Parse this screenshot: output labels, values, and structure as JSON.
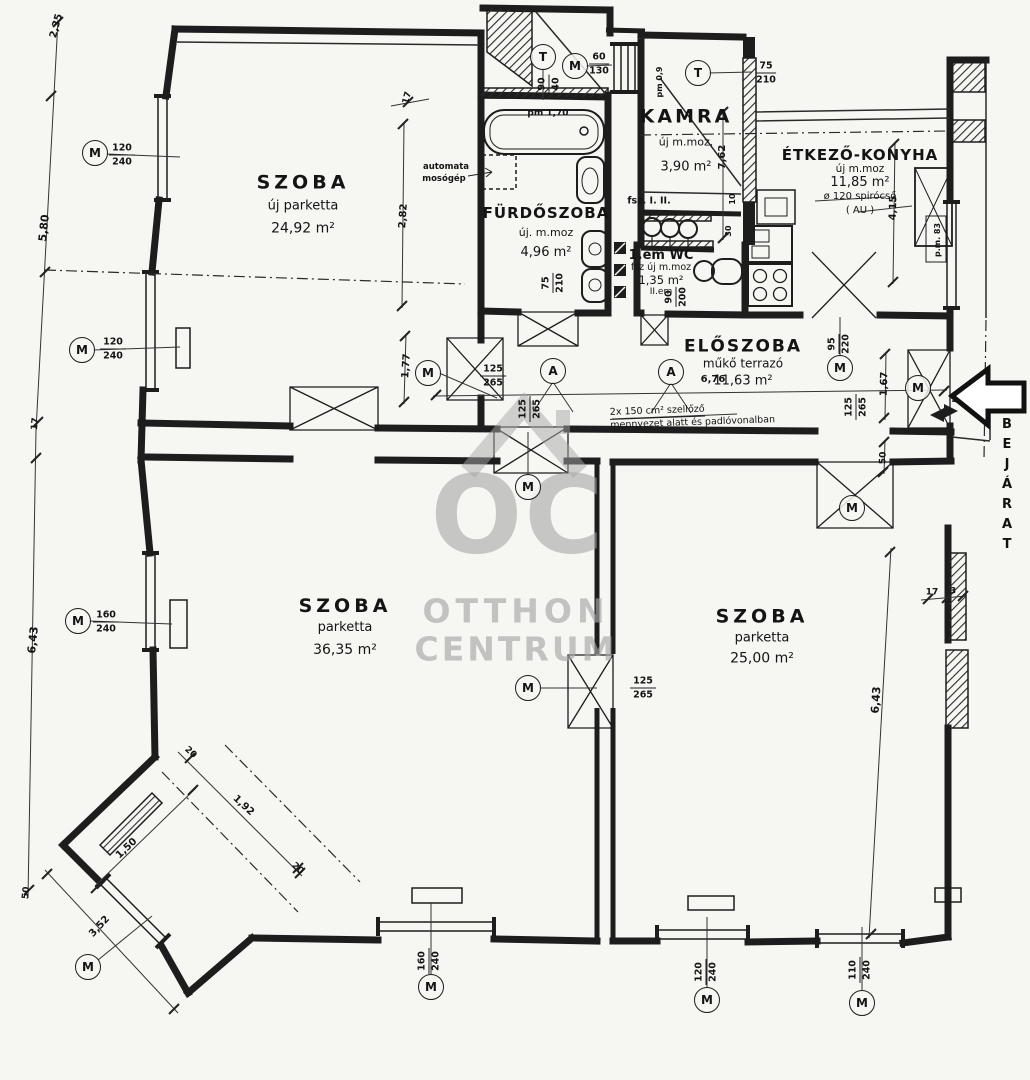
{
  "title": "Apartment floor plan (Otthon Centrum)",
  "colors": {
    "ink": "#1d1d1d",
    "background": "#f6f6f2",
    "watermark": "#a7a7a7"
  },
  "watermark": {
    "monogram": "OC",
    "line1": "OTTHON",
    "line2": "CENTRUM"
  },
  "entrance": {
    "label": "BEJÁRAT"
  },
  "vent_note": {
    "line1": "2x 150 cm² szellőző",
    "line2": "mennyezet alatt és padlóvonalban"
  },
  "rooms": [
    {
      "x": 303,
      "y": 206,
      "lines": [
        {
          "t": "SZOBA",
          "fs": 19,
          "ls": 4
        },
        {
          "t": "új parketta",
          "fs": 13
        },
        {
          "t": "24,92 m²",
          "fs": 14
        }
      ],
      "lh": 23
    },
    {
      "x": 546,
      "y": 233,
      "lines": [
        {
          "t": "FÜRDŐSZOBA",
          "fs": 15,
          "ls": 1
        },
        {
          "t": "új. m.moz",
          "fs": 11
        },
        {
          "t": "4,96 m²",
          "fs": 13
        }
      ],
      "lh": 20
    },
    {
      "x": 686,
      "y": 142,
      "lines": [
        {
          "t": "KAMRA",
          "fs": 19,
          "ls": 3
        },
        {
          "t": "új m.moz.",
          "fs": 11
        },
        {
          "t": "3,90 m²",
          "fs": 13
        }
      ],
      "lh": 25
    },
    {
      "x": 860,
      "y": 183,
      "lines": [
        {
          "t": "ÉTKEZŐ-KONYHA",
          "fs": 15,
          "ls": 1
        },
        {
          "t": "új  m.moz",
          "fs": 10.5
        },
        {
          "t": "11,85 m²",
          "fs": 13
        },
        {
          "t": "ø 120 spirócső",
          "fs": 10
        },
        {
          "t": "( AU )",
          "fs": 10
        }
      ],
      "lh": 14
    },
    {
      "x": 661,
      "y": 274,
      "lines": [
        {
          "t": "1.em  WC",
          "fs": 13
        },
        {
          "t": "fsz új m.moz",
          "fs": 9.5
        },
        {
          "t": "1,35 m²",
          "fs": 11.5
        },
        {
          "t": "II.em",
          "fs": 9
        }
      ],
      "lh": 12
    },
    {
      "x": 743,
      "y": 364,
      "lines": [
        {
          "t": "ELŐSZOBA",
          "fs": 17,
          "ls": 2
        },
        {
          "t": "műkő terrazó",
          "fs": 12
        },
        {
          "t": "11,63 m²",
          "fs": 13
        }
      ],
      "lh": 17
    },
    {
      "x": 345,
      "y": 628,
      "lines": [
        {
          "t": "SZOBA",
          "fs": 19,
          "ls": 4
        },
        {
          "t": "parketta",
          "fs": 13
        },
        {
          "t": "36,35 m²",
          "fs": 14
        }
      ],
      "lh": 22
    },
    {
      "x": 762,
      "y": 638,
      "lines": [
        {
          "t": "SZOBA",
          "fs": 19,
          "ls": 4
        },
        {
          "t": "parketta",
          "fs": 13
        },
        {
          "t": "25,00 m²",
          "fs": 14
        }
      ],
      "lh": 21
    }
  ],
  "symbols": [
    {
      "letter": "M",
      "x": 95,
      "y": 153
    },
    {
      "letter": "M",
      "x": 82,
      "y": 350
    },
    {
      "letter": "M",
      "x": 78,
      "y": 621
    },
    {
      "letter": "M",
      "x": 88,
      "y": 967
    },
    {
      "letter": "M",
      "x": 431,
      "y": 987
    },
    {
      "letter": "M",
      "x": 707,
      "y": 1000
    },
    {
      "letter": "M",
      "x": 862,
      "y": 1003
    },
    {
      "letter": "M",
      "x": 428,
      "y": 373
    },
    {
      "letter": "M",
      "x": 528,
      "y": 487
    },
    {
      "letter": "M",
      "x": 528,
      "y": 688
    },
    {
      "letter": "M",
      "x": 840,
      "y": 368
    },
    {
      "letter": "M",
      "x": 918,
      "y": 388
    },
    {
      "letter": "M",
      "x": 852,
      "y": 508
    },
    {
      "letter": "M",
      "x": 575,
      "y": 66
    },
    {
      "letter": "T",
      "x": 543,
      "y": 57
    },
    {
      "letter": "T",
      "x": 698,
      "y": 73
    },
    {
      "letter": "A",
      "x": 553,
      "y": 371
    },
    {
      "letter": "A",
      "x": 671,
      "y": 372
    }
  ],
  "fractions": [
    {
      "num": "120",
      "den": "240",
      "x": 122,
      "y": 155,
      "rot": 0
    },
    {
      "num": "120",
      "den": "240",
      "x": 113,
      "y": 349,
      "rot": 0
    },
    {
      "num": "160",
      "den": "240",
      "x": 106,
      "y": 622,
      "rot": 0
    },
    {
      "num": "60",
      "den": "130",
      "x": 599,
      "y": 64,
      "rot": 0
    },
    {
      "num": "75",
      "den": "210",
      "x": 766,
      "y": 73,
      "rot": 0
    },
    {
      "num": "125",
      "den": "265",
      "x": 493,
      "y": 376,
      "rot": 0
    },
    {
      "num": "125",
      "den": "265",
      "x": 643,
      "y": 688,
      "rot": 0
    },
    {
      "num": "75",
      "den": "210",
      "x": 553,
      "y": 283,
      "rot": -90
    },
    {
      "num": "90",
      "den": "200",
      "x": 676,
      "y": 297,
      "rot": -90
    },
    {
      "num": "125",
      "den": "265",
      "x": 530,
      "y": 409,
      "rot": -90
    },
    {
      "num": "95",
      "den": "220",
      "x": 839,
      "y": 344,
      "rot": -90
    },
    {
      "num": "125",
      "den": "265",
      "x": 856,
      "y": 407,
      "rot": -90
    },
    {
      "num": "160",
      "den": "240",
      "x": 429,
      "y": 961,
      "rot": -90
    },
    {
      "num": "120",
      "den": "240",
      "x": 706,
      "y": 972,
      "rot": -90
    },
    {
      "num": "110",
      "den": "240",
      "x": 860,
      "y": 970,
      "rot": -90
    },
    {
      "num": "90",
      "den": "40",
      "x": 549,
      "y": 84,
      "rot": -90
    }
  ],
  "dims": [
    {
      "t": "2,35",
      "x": 57,
      "y": 26,
      "rot": -75,
      "fs": 10
    },
    {
      "t": "5,80",
      "x": 44,
      "y": 228,
      "rot": -84,
      "fs": 11
    },
    {
      "t": "17",
      "x": 36,
      "y": 424,
      "rot": -84,
      "fs": 9
    },
    {
      "t": "6,43",
      "x": 33,
      "y": 640,
      "rot": -84,
      "fs": 11
    },
    {
      "t": "50",
      "x": 27,
      "y": 893,
      "rot": -84,
      "fs": 9
    },
    {
      "t": "3,52",
      "x": 100,
      "y": 927,
      "rot": -47,
      "fs": 10
    },
    {
      "t": "1,50",
      "x": 127,
      "y": 849,
      "rot": -43,
      "fs": 10
    },
    {
      "t": "1,92",
      "x": 243,
      "y": 806,
      "rot": 43,
      "fs": 10
    },
    {
      "t": "20",
      "x": 190,
      "y": 753,
      "rot": 43,
      "fs": 9
    },
    {
      "t": "20",
      "x": 297,
      "y": 869,
      "rot": 43,
      "fs": 9
    },
    {
      "t": "17",
      "x": 408,
      "y": 98,
      "rot": -75,
      "fs": 9
    },
    {
      "t": "2,82",
      "x": 404,
      "y": 216,
      "rot": -86,
      "fs": 10
    },
    {
      "t": "1,77",
      "x": 407,
      "y": 366,
      "rot": -86,
      "fs": 10
    },
    {
      "t": "7,62",
      "x": 723,
      "y": 157,
      "rot": -90,
      "fs": 10
    },
    {
      "t": "4,15",
      "x": 894,
      "y": 208,
      "rot": -88,
      "fs": 10
    },
    {
      "t": "1,67",
      "x": 885,
      "y": 384,
      "rot": -88,
      "fs": 10
    },
    {
      "t": "50",
      "x": 884,
      "y": 458,
      "rot": -88,
      "fs": 9
    },
    {
      "t": "6,76",
      "x": 713,
      "y": 380,
      "rot": 0,
      "fs": 10
    },
    {
      "t": "6,43",
      "x": 876,
      "y": 700,
      "rot": -86,
      "fs": 11
    },
    {
      "t": "17",
      "x": 932,
      "y": 593,
      "rot": 0,
      "fs": 9
    },
    {
      "t": "3",
      "x": 953,
      "y": 592,
      "rot": 0,
      "fs": 9
    },
    {
      "t": "pm 1,70",
      "x": 548,
      "y": 114,
      "rot": 0,
      "fs": 9
    },
    {
      "t": "automata",
      "x": 446,
      "y": 167,
      "rot": 0,
      "fs": 8.5
    },
    {
      "t": "mosógép",
      "x": 444,
      "y": 179,
      "rot": 0,
      "fs": 8.5
    },
    {
      "t": "fsz.  I.  II.",
      "x": 649,
      "y": 201,
      "rot": 0,
      "fs": 9.5
    },
    {
      "t": "p.m. 83",
      "x": 938,
      "y": 240,
      "rot": -90,
      "fs": 8
    },
    {
      "t": "pm 0,9",
      "x": 660,
      "y": 82,
      "rot": -90,
      "fs": 8
    },
    {
      "t": "10",
      "x": 733,
      "y": 199,
      "rot": -90,
      "fs": 8
    },
    {
      "t": "30",
      "x": 729,
      "y": 231,
      "rot": -90,
      "fs": 8
    }
  ]
}
